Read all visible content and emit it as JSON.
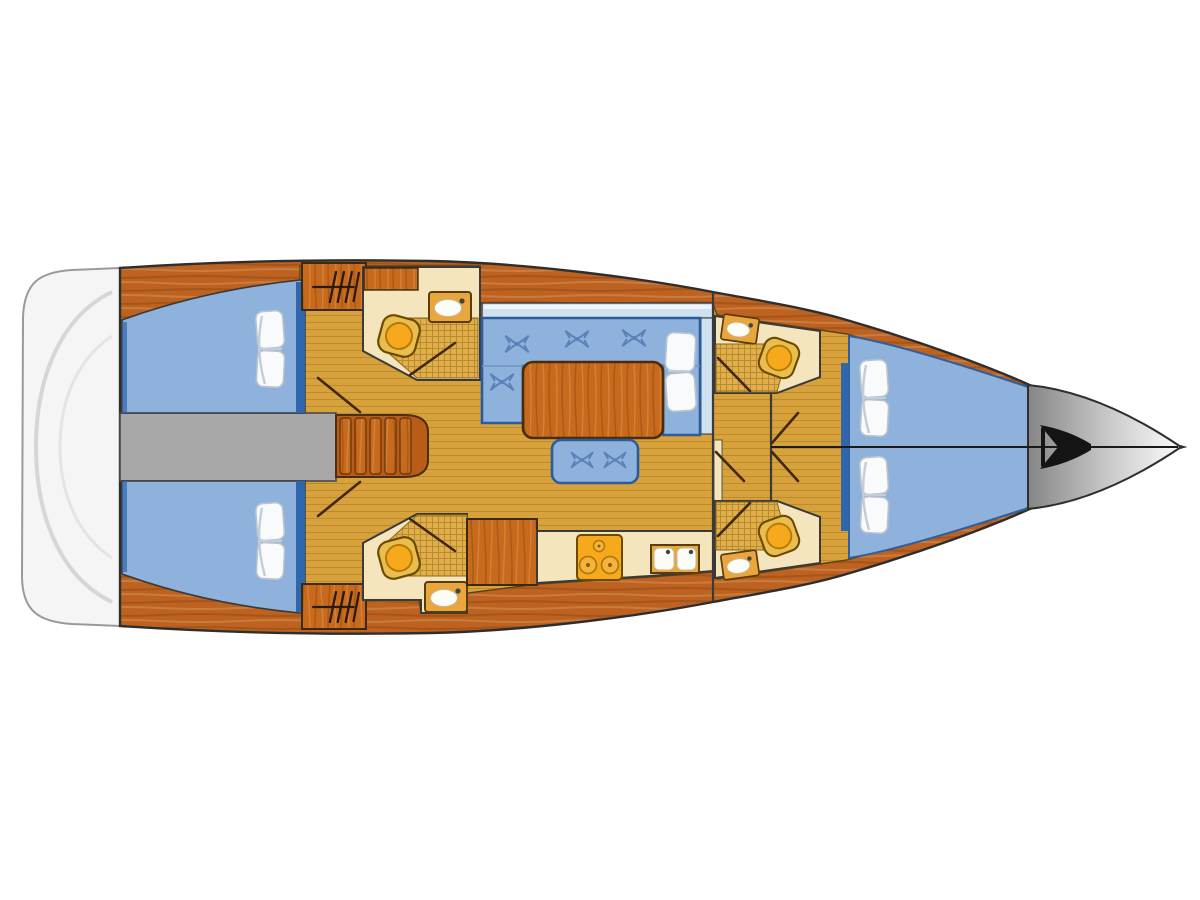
{
  "diagram": {
    "type": "yacht-interior-floor-plan",
    "label": "Sailing yacht interior layout floor plan, bow facing right",
    "orientation": "bow-right",
    "features": [
      {
        "name": "swim-platform",
        "count": 1
      },
      {
        "name": "aft-double-cabin",
        "count": 2
      },
      {
        "name": "engine-compartment",
        "count": 1
      },
      {
        "name": "companionway-steps",
        "count": 1
      },
      {
        "name": "head-with-shower-toilet-sink",
        "count": 4
      },
      {
        "name": "hanging-locker",
        "count": 4
      },
      {
        "name": "saloon-u-sofa-with-table",
        "count": 1
      },
      {
        "name": "saloon-bench-seat",
        "count": 1
      },
      {
        "name": "galley-three-burner-stove",
        "count": 1
      },
      {
        "name": "galley-double-sink",
        "count": 1
      },
      {
        "name": "forward-v-berth-cabin",
        "count": 1
      },
      {
        "name": "anchor-locker",
        "count": 1
      },
      {
        "name": "berth-pillow-pair",
        "count": 4
      }
    ],
    "colors": {
      "background": "#ffffff",
      "outline": "#2e2e2e",
      "hull_wood": "#bd6220",
      "furniture_wood": "#c86a1d",
      "floor": "#d7a13c",
      "grid_base": "#e0af4a",
      "cream": "#f4e5bd",
      "upholstery": "#8fb2dc",
      "upholstery_dark": "#2f66ad",
      "upholstery_border": "#2b5d9e",
      "stitch": "#5b82b8",
      "window": "#cfe0ef",
      "window_hi": "#eef5fb",
      "engine_gray": "#a8a8a8",
      "fixture_orange": "#f6a91c",
      "fixture_rim": "#e9bd4e",
      "fixture_outline": "#6b4a00",
      "sink_frame": "#e8a63c",
      "white_fixture": "#fdfdf8",
      "pillow": "#f8fafc",
      "pillow_shade": "#c3cdd8",
      "anchor": "#141414",
      "transom": "#f5f5f5",
      "transom_line": "#d6d6d6",
      "door_line": "#40290a"
    }
  }
}
